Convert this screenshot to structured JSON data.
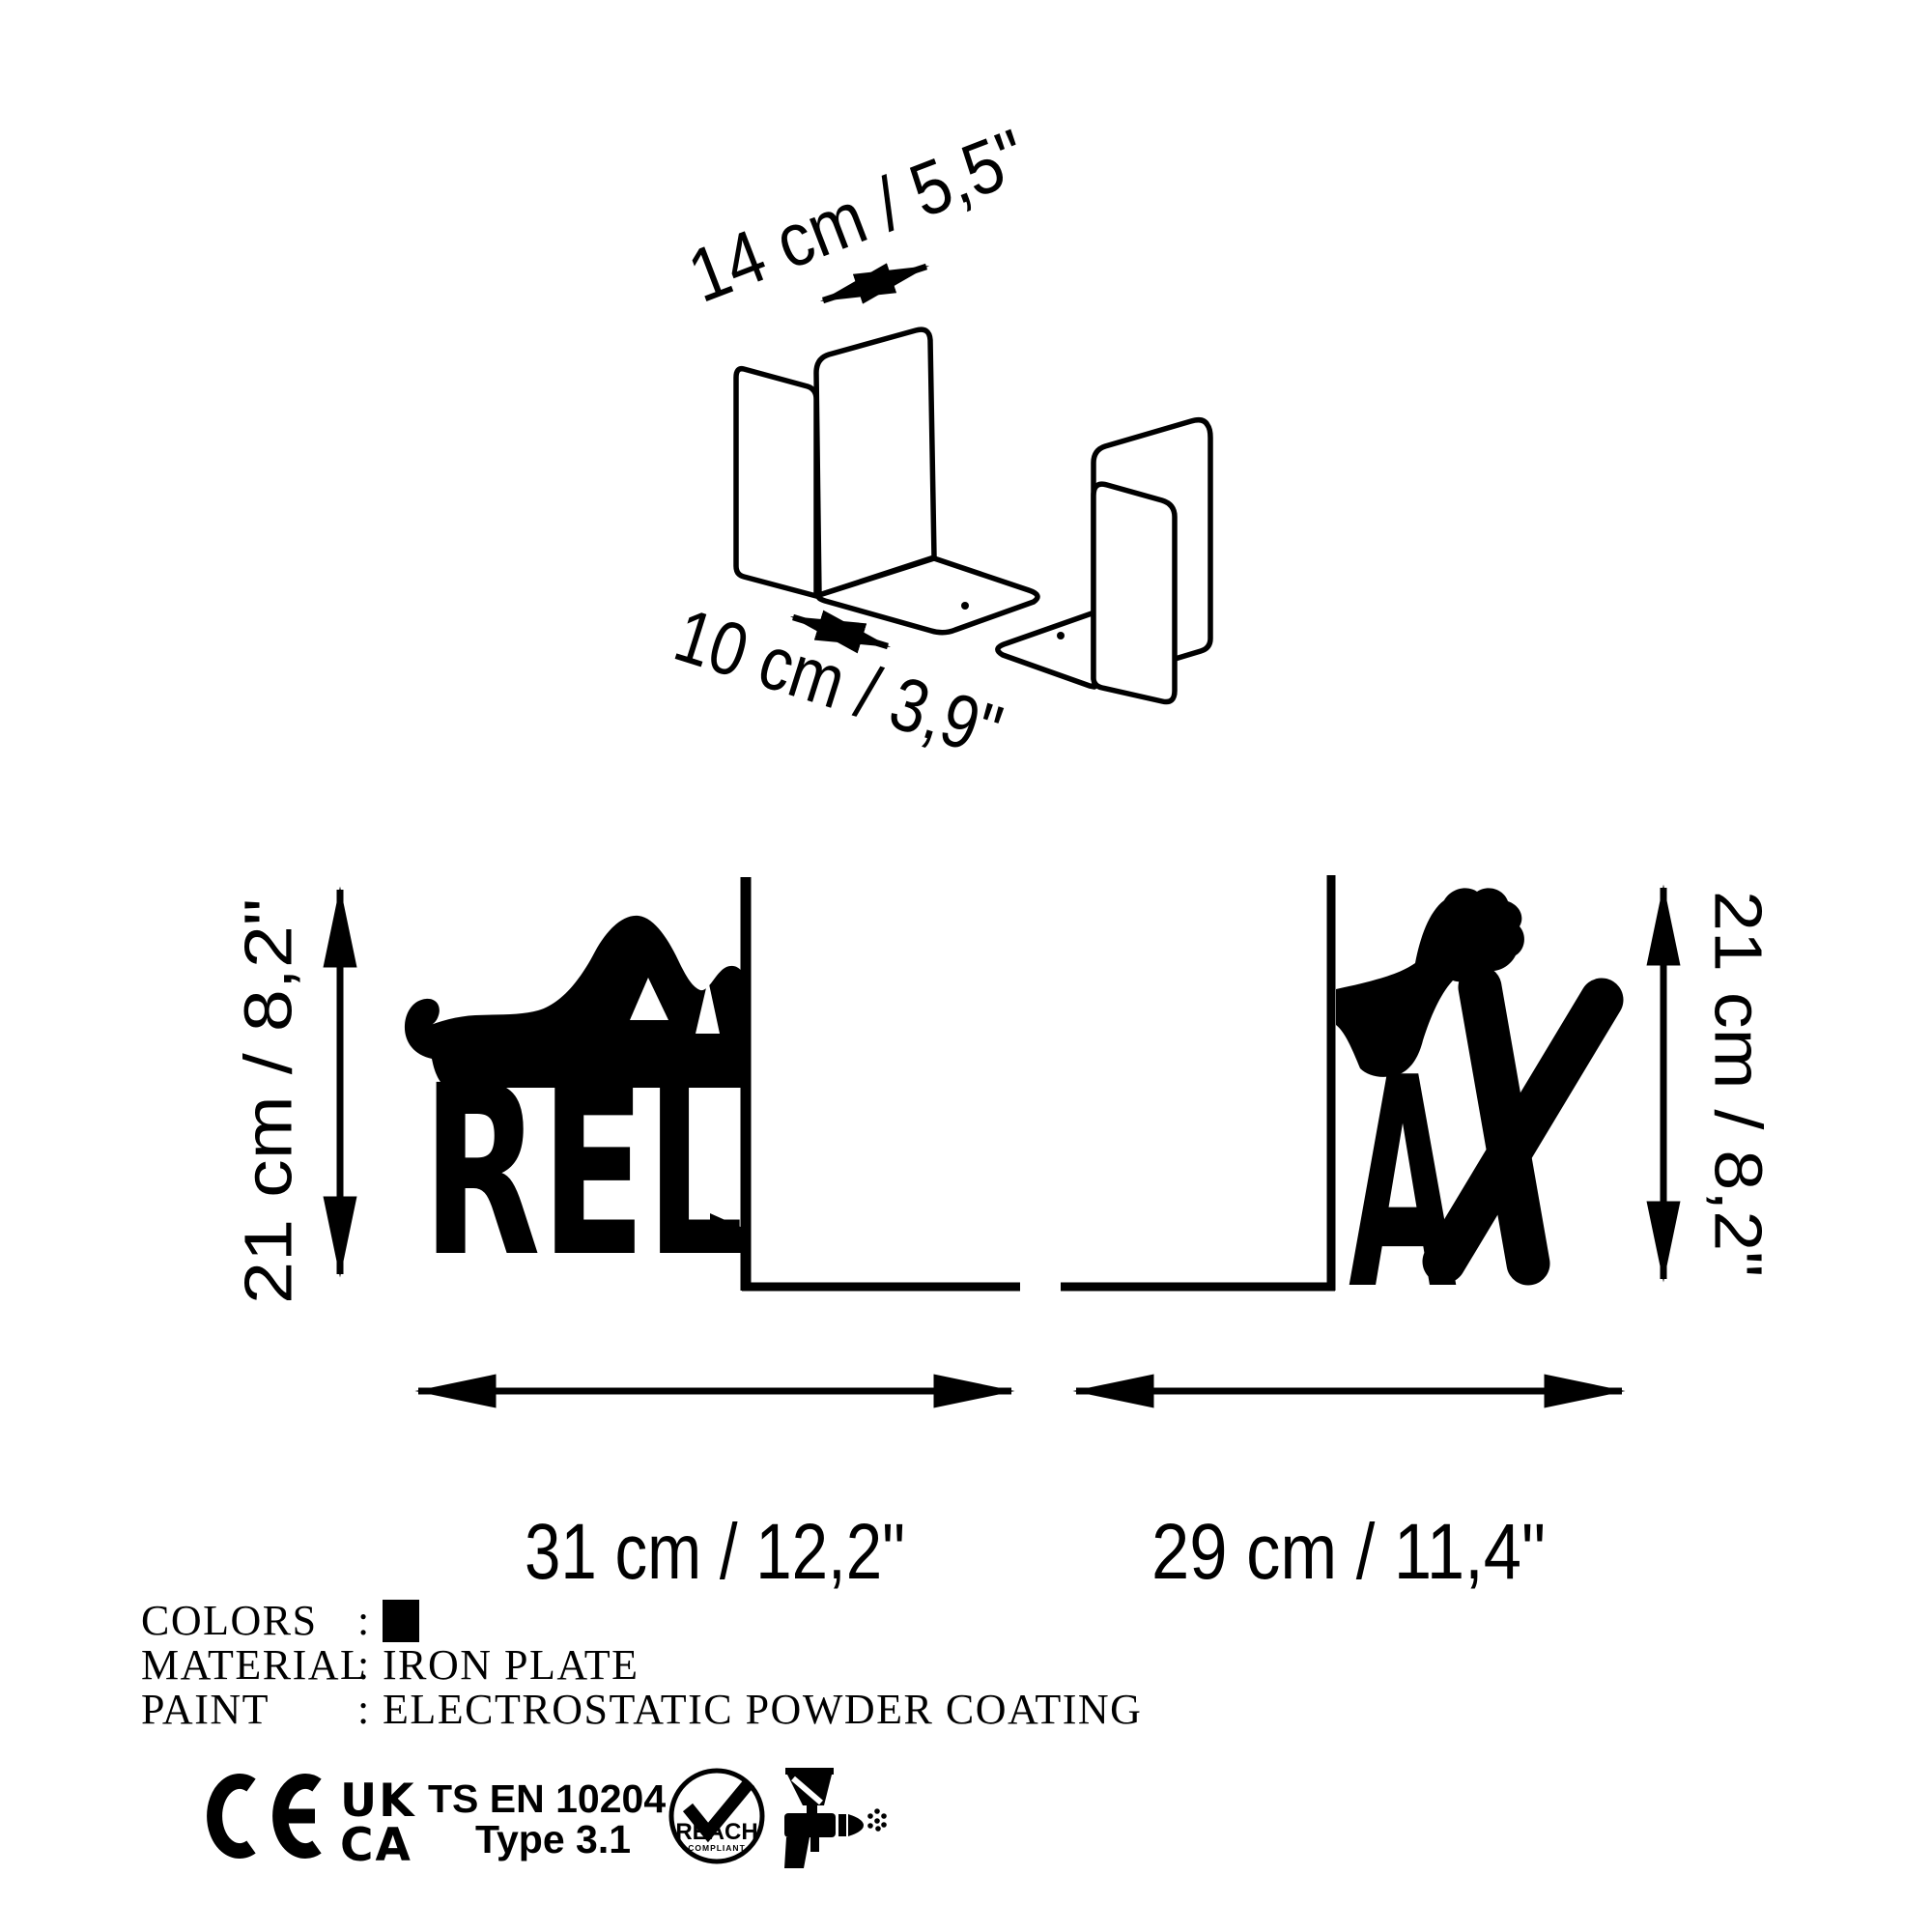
{
  "colors": {
    "ink": "#000000",
    "paper": "#ffffff",
    "swatch": "#000000"
  },
  "top_view": {
    "width_label": "14 cm / 5,5\"",
    "depth_label": "10 cm / 3,9\""
  },
  "front_view": {
    "left_letters": "REL",
    "right_letter_a": "A",
    "right_letter_x": "X",
    "left_height_label": "21 cm / 8,2\"",
    "right_height_label": "21 cm / 8,2\"",
    "left_width_label": "31 cm / 12,2\"",
    "right_width_label": "29 cm / 11,4\""
  },
  "specs": {
    "rows": [
      {
        "label": "COLORS",
        "colon": ":",
        "value": "",
        "swatch": "#000000"
      },
      {
        "label": "MATERIAL",
        "colon": ":",
        "value": "IRON PLATE"
      },
      {
        "label": "PAINT",
        "colon": ":",
        "value": "ELECTROSTATIC POWDER COATING"
      }
    ]
  },
  "certifications": {
    "ukca_top": "UK",
    "ukca_bottom": "CA",
    "standard": "TS EN 10204",
    "standard_type": "Type 3.1",
    "reach": "REACH",
    "reach_sub": "COMPLIANT"
  }
}
